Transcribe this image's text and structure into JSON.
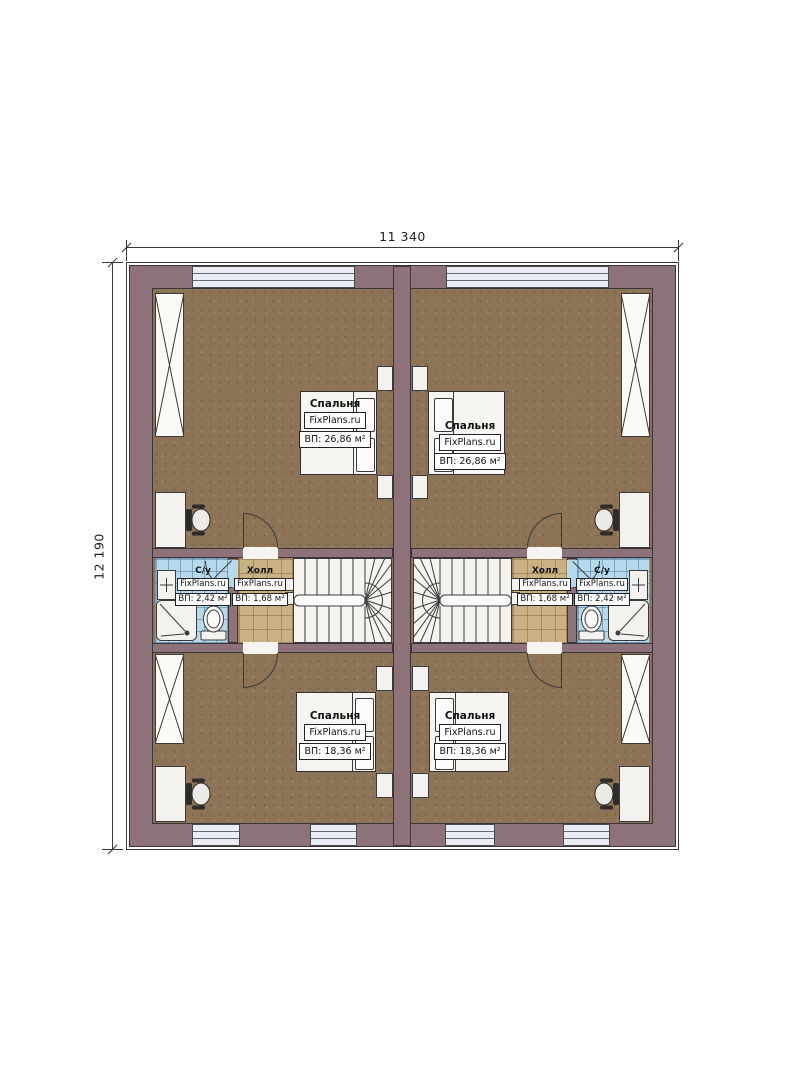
{
  "dimensions": {
    "width": "11 340",
    "height": "12 190"
  },
  "rooms": {
    "bedroom_top_left": {
      "name": "Спальня",
      "watermark": "FixPlans.ru",
      "area": "ВП: 26,86 м²"
    },
    "bedroom_top_right": {
      "name": "Спальня",
      "watermark": "FixPlans.ru",
      "area": "ВП: 26,86 м²"
    },
    "bedroom_bottom_left": {
      "name": "Спальня",
      "watermark": "FixPlans.ru",
      "area": "ВП: 18,36 м²"
    },
    "bedroom_bottom_right": {
      "name": "Спальня",
      "watermark": "FixPlans.ru",
      "area": "ВП: 18,36 м²"
    },
    "bathroom_left": {
      "name": "С/у",
      "watermark": "FixPlans.ru",
      "area": "ВП: 2,42 м²"
    },
    "bathroom_right": {
      "name": "С/у",
      "watermark": "FixPlans.ru",
      "area": "ВП: 2,42 м²"
    },
    "hall_left": {
      "name": "Холл",
      "watermark": "FixPlans.ru",
      "area": "ВП: 1,68 м²"
    },
    "hall_right": {
      "name": "Холл",
      "watermark": "FixPlans.ru",
      "area": "ВП: 1,68 м²"
    }
  },
  "colors": {
    "wall": "#8d7379",
    "outline": "#3b3438",
    "floor": "#8d7456",
    "hall_tile": "#c9b183",
    "bath_tile": "#b7d9ec",
    "window_glass": "#e9edf3",
    "stair": "#f6f4f0"
  }
}
